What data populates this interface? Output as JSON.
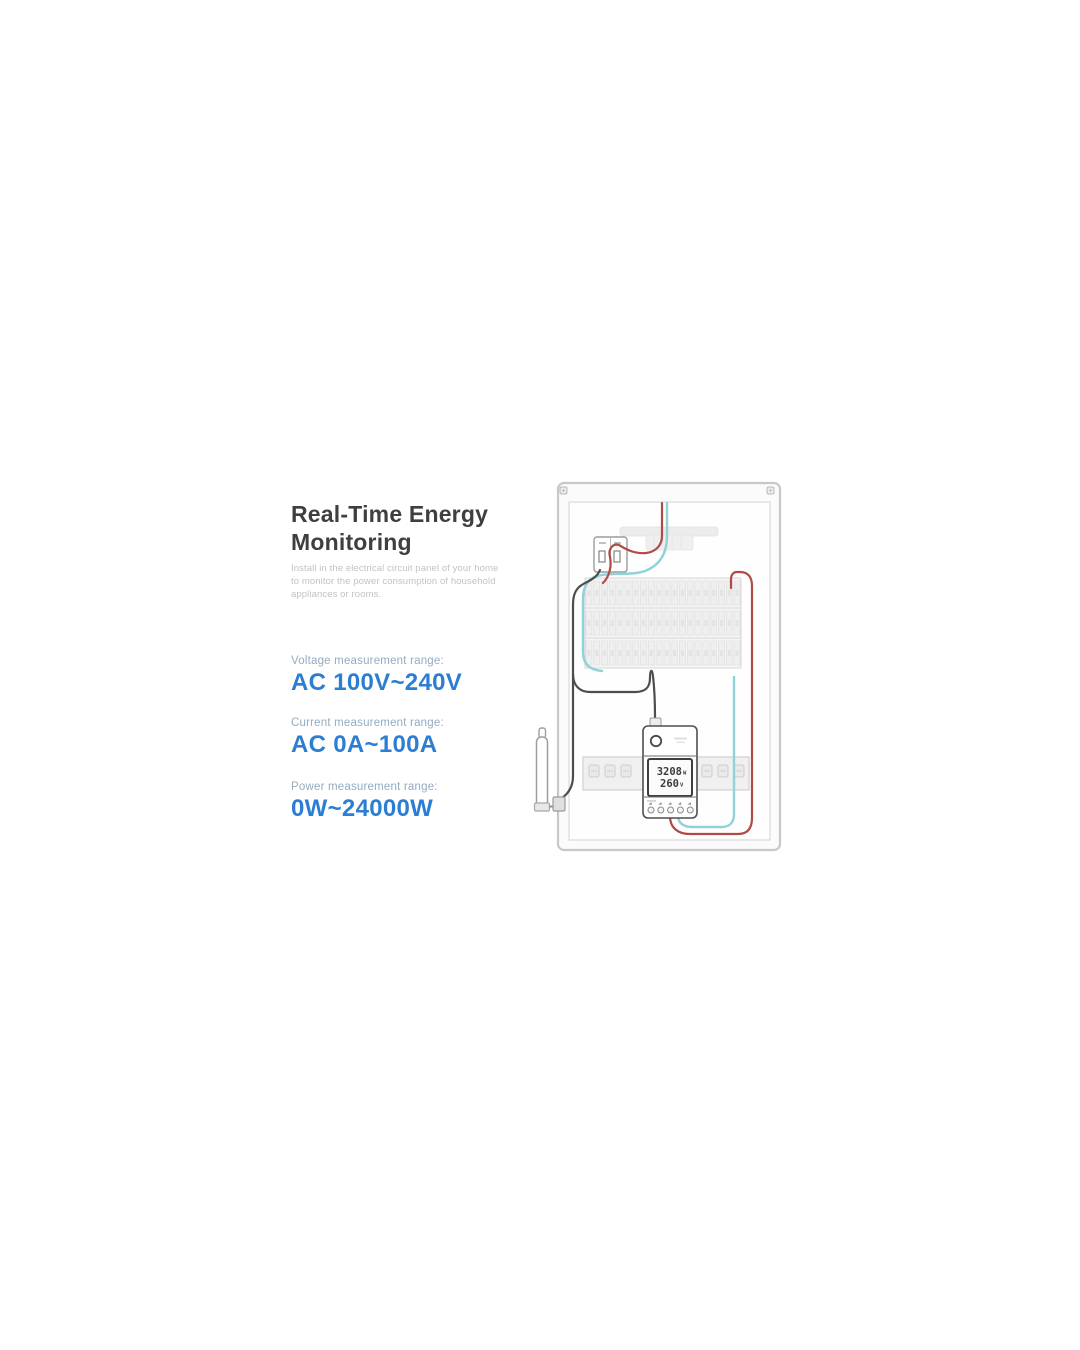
{
  "header": {
    "title_line1": "Real-Time Energy",
    "title_line2": "Monitoring",
    "description_line1": "Install in the electrical circuit panel of your home",
    "description_line2": "to monitor the power consumption of household",
    "description_line3": "appliances or rooms."
  },
  "specs": [
    {
      "label": "Voltage measurement range:",
      "value": "AC 100V~240V"
    },
    {
      "label": "Current measurement range:",
      "value": "AC 0A~100A"
    },
    {
      "label": "Power measurement range:",
      "value": "0W~24000W"
    }
  ],
  "colors": {
    "accent_blue": "#2c7ed2",
    "label_blue_gray": "#94abc0",
    "title_gray": "#3f3f3f",
    "live_wire_red": "#b04a45",
    "neutral_wire_cyan": "#8fd3d8",
    "load_wire_dark": "#4d4d4d"
  },
  "diagram": {
    "meter_display": {
      "power_value": "3208",
      "power_unit": "W",
      "voltage_value": "260",
      "voltage_unit": "V"
    }
  }
}
